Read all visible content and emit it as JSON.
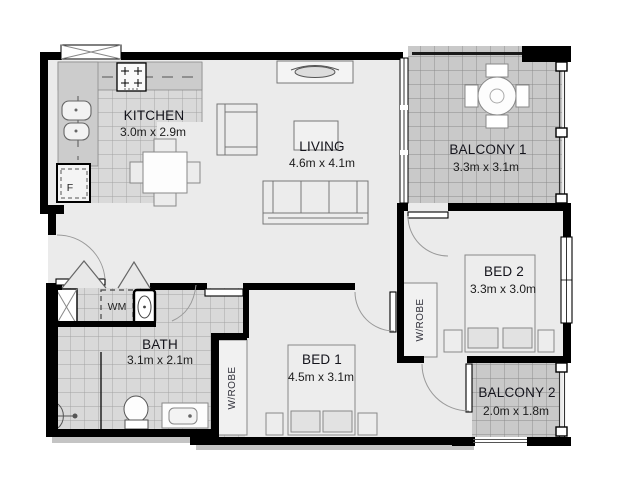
{
  "plan": {
    "rooms": {
      "kitchen": {
        "name": "KITCHEN",
        "dims": "3.0m x 2.9m"
      },
      "living": {
        "name": "LIVING",
        "dims": "4.6m x 4.1m"
      },
      "balcony1": {
        "name": "BALCONY 1",
        "dims": "3.3m x 3.1m"
      },
      "bed2": {
        "name": "BED 2",
        "dims": "3.3m x 3.0m"
      },
      "bed1": {
        "name": "BED 1",
        "dims": "4.5m x 3.1m"
      },
      "bath": {
        "name": "BATH",
        "dims": "3.1m x 2.1m"
      },
      "balcony2": {
        "name": "BALCONY 2",
        "dims": "2.0m x 1.8m"
      }
    },
    "labels": {
      "wrobe_bed1": "W/ROBE",
      "wrobe_bed2": "W/ROBE",
      "washing_machine": "WM",
      "fridge": "F"
    },
    "colors": {
      "wall": "#000000",
      "floor": "#ebebeb",
      "tile": "#d9d9d9",
      "balcony_tile": "#c9c9c9"
    }
  }
}
